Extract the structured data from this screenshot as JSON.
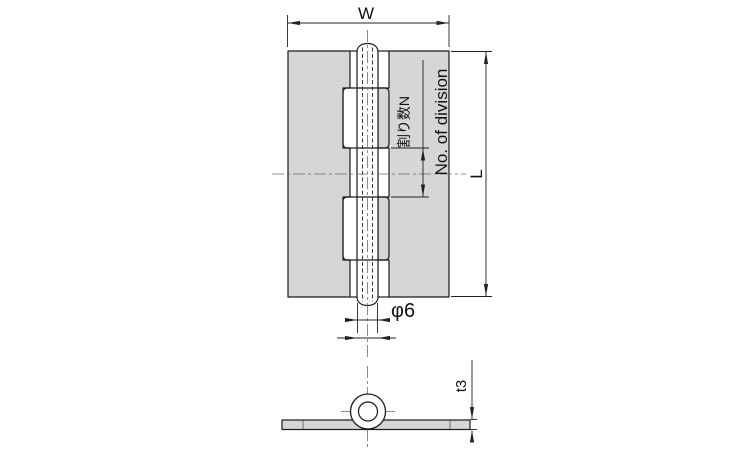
{
  "drawing": {
    "labels": {
      "width": "W",
      "length": "L",
      "division_ja": "割り数N",
      "division_en": "No. of division",
      "pin_diameter": "φ6",
      "thickness": "t3"
    },
    "colors": {
      "plate_fill": "#d6d6d6",
      "outline": "#1a1a1a",
      "dimension_line": "#222222",
      "centerline": "#6e6e6e",
      "background": "#ffffff"
    }
  }
}
